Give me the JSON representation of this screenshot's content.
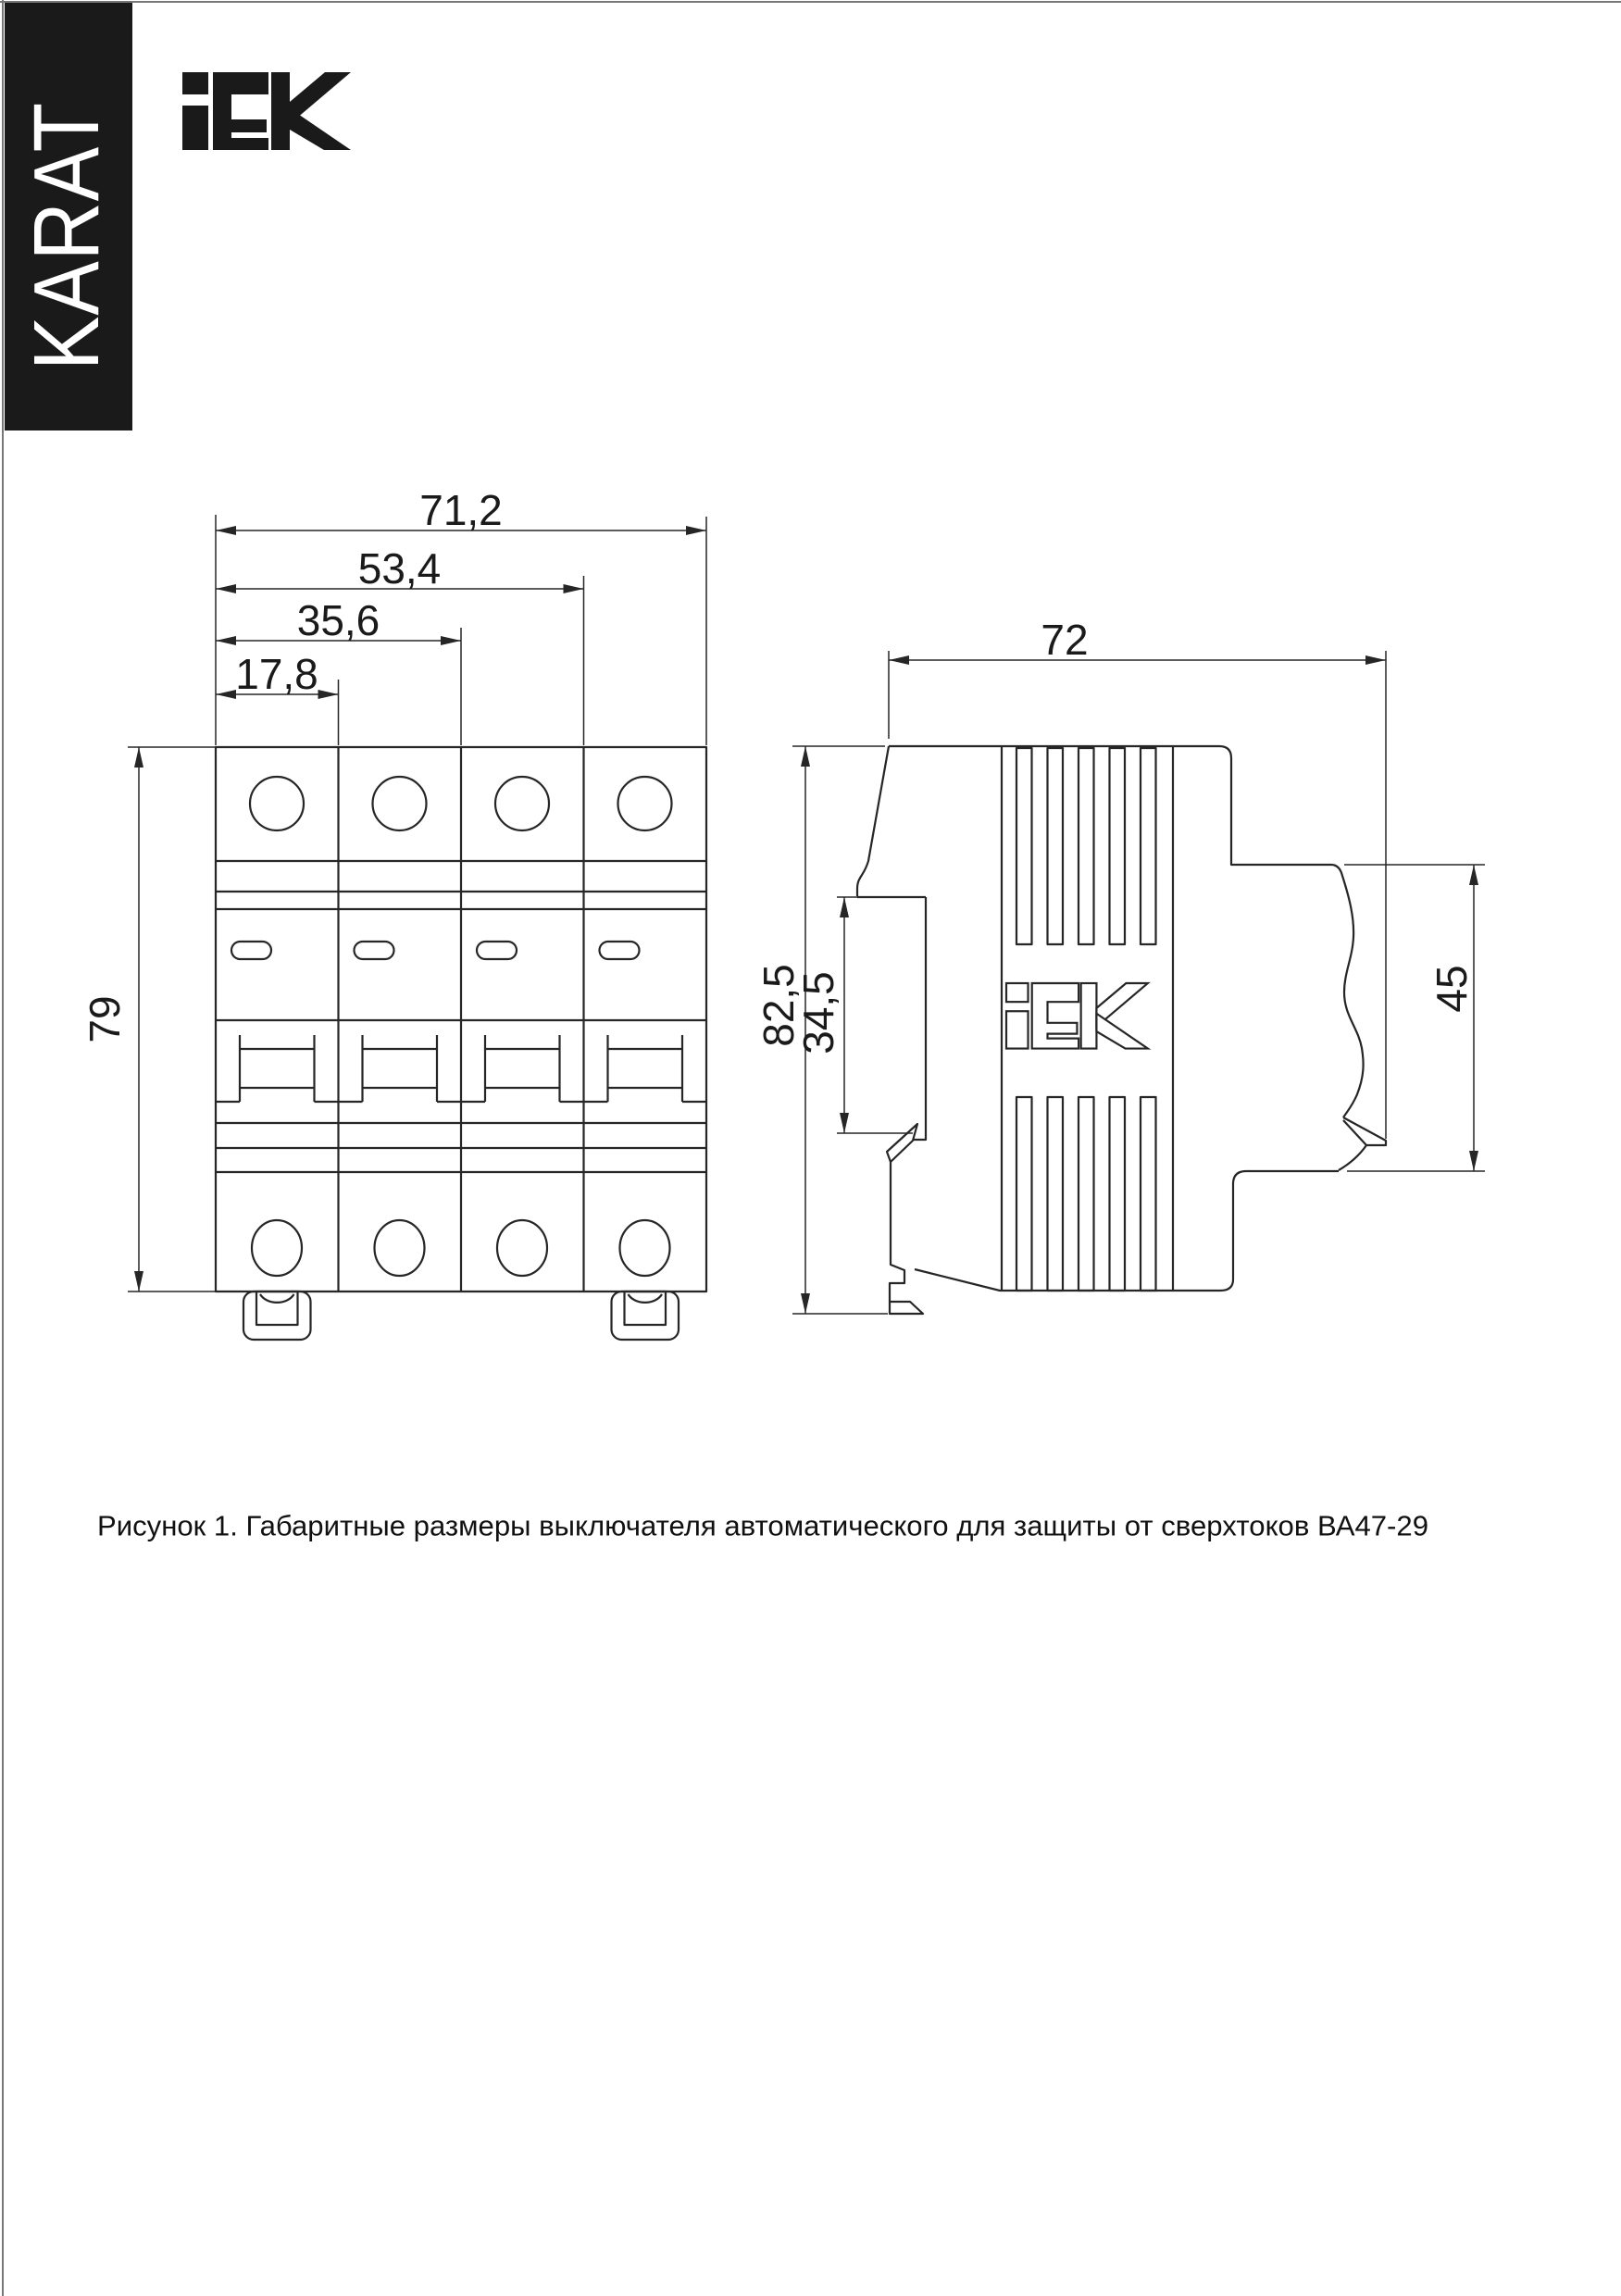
{
  "page": {
    "background": "#ffffff",
    "ink": "#262626"
  },
  "banner": {
    "text": "KARAT",
    "bg": "#1a1a1a",
    "fg": "#ffffff"
  },
  "brand": {
    "name": "IEK"
  },
  "dimensions": {
    "front": {
      "total_width": "71,2",
      "three_modules": "53,4",
      "two_modules": "35,6",
      "one_module": "17,8",
      "height": "79"
    },
    "side": {
      "depth": "72",
      "total_height": "82,5",
      "rail_recess": "34,5",
      "front_height": "45"
    }
  },
  "caption": {
    "text": "Рисунок 1. Габаритные размеры выключателя автоматического для защиты от сверхтоков ВА47-29"
  }
}
